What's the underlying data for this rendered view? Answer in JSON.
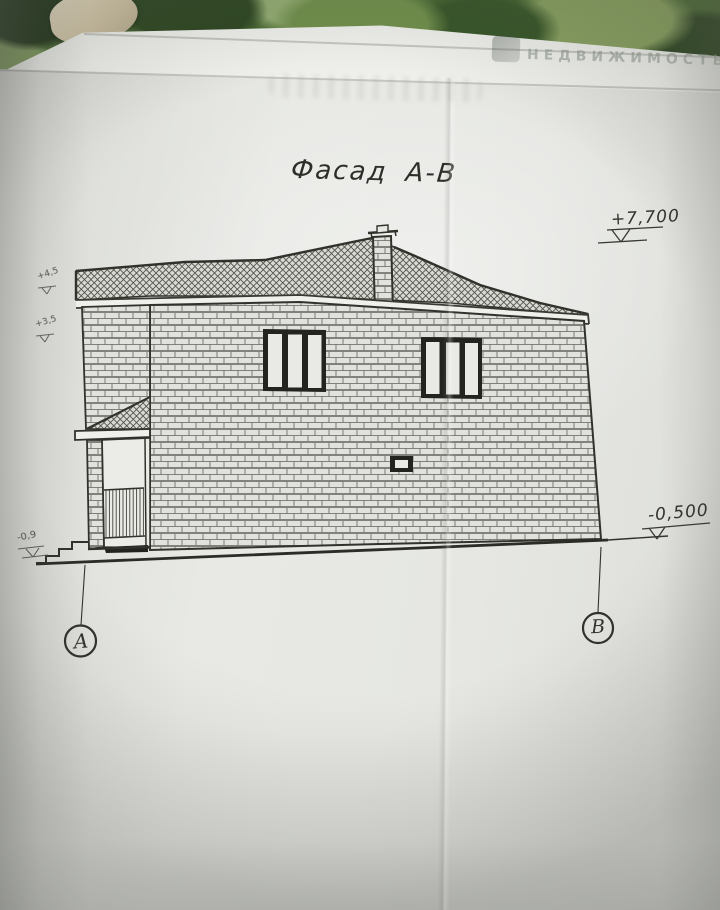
{
  "photo": {
    "background": "camouflage-fabric",
    "watermark": "НЕДВИЖИМОСТЬ"
  },
  "drawing": {
    "title": "Фасад А-В",
    "axes": [
      {
        "id": "A",
        "label": "А"
      },
      {
        "id": "B",
        "label": "В"
      }
    ],
    "elevation_marks": [
      {
        "id": "ridge",
        "label": "+7,700"
      },
      {
        "id": "ground-right",
        "label": "-0,500"
      },
      {
        "id": "left-upper",
        "label": "+4,5"
      },
      {
        "id": "left-lower",
        "label": "+3,5"
      },
      {
        "id": "ground-left",
        "label": "-0,9"
      }
    ],
    "colors": {
      "paper": "#e7e8e4",
      "ink": "#32322c",
      "camo_dark": "#2c4520",
      "camo_mid": "#56763c",
      "camo_light": "#8aa468"
    }
  }
}
